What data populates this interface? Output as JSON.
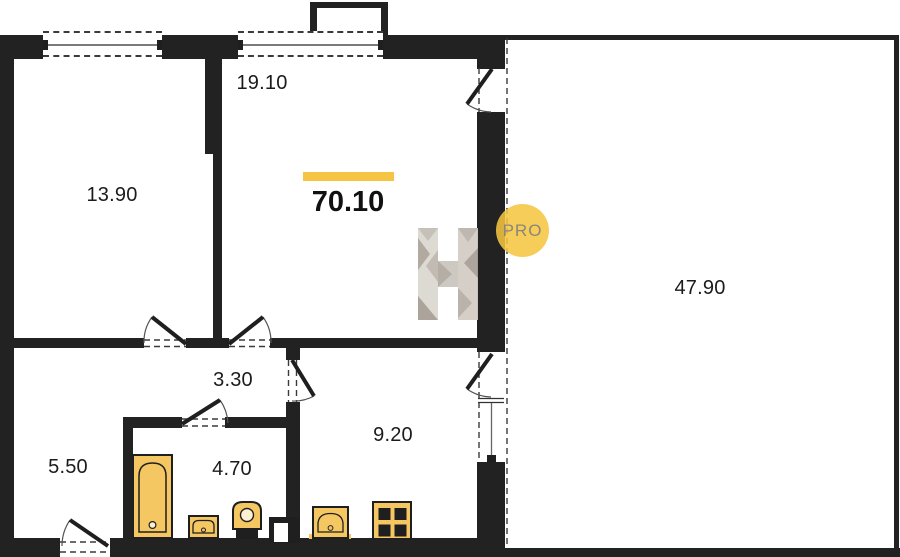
{
  "plan": {
    "total": {
      "area": "70.10"
    },
    "rooms": [
      {
        "id": "bedroom",
        "area": "13.90"
      },
      {
        "id": "living-room",
        "area": "19.10"
      },
      {
        "id": "terrace",
        "area": "47.90"
      },
      {
        "id": "hallway",
        "area": "3.30"
      },
      {
        "id": "entry-hall",
        "area": "5.50"
      },
      {
        "id": "bathroom",
        "area": "4.70"
      },
      {
        "id": "kitchen",
        "area": "9.20"
      }
    ],
    "watermark": {
      "badge": "PRO",
      "logo_letter": "H"
    },
    "colors": {
      "accent": "#f6c443",
      "wall": "#222222",
      "fixture_fill": "#f5c763"
    }
  }
}
